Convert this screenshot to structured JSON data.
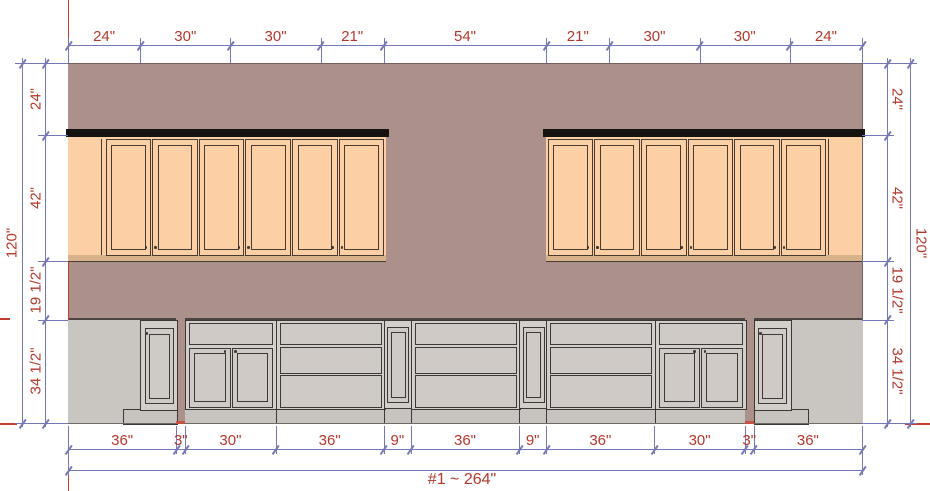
{
  "drawing": {
    "annotations": {
      "hood": "Hood",
      "spice_left": "Spice",
      "cooktop": "Cooktop",
      "spice_right": "Spice"
    },
    "overall_label": "#1 ~ 264\"",
    "dims": {
      "top": {
        "labels": [
          "24\"",
          "30\"",
          "30\"",
          "21\"",
          "54\"",
          "21\"",
          "30\"",
          "30\"",
          "24\""
        ],
        "inches": [
          24,
          30,
          30,
          21,
          54,
          21,
          30,
          30,
          24
        ]
      },
      "bottom": {
        "labels": [
          "36\"",
          "3\"",
          "30\"",
          "36\"",
          "9\"",
          "36\"",
          "9\"",
          "36\"",
          "30\"",
          "3\"",
          "36\""
        ],
        "inches": [
          36,
          3,
          30,
          36,
          9,
          36,
          9,
          36,
          30,
          3,
          36
        ]
      },
      "left": {
        "labels": [
          "24\"",
          "42\"",
          "19 1/2\"",
          "34 1/2\""
        ],
        "inches": [
          24,
          42,
          19.5,
          34.5
        ],
        "overall": "120\""
      },
      "right": {
        "labels": [
          "24\"",
          "42\"",
          "19 1/2\"",
          "34 1/2\""
        ],
        "inches": [
          24,
          42,
          19.5,
          34.5
        ],
        "overall": "120\""
      }
    },
    "colors": {
      "wall": "#ab908c",
      "wall_edge": "#74615e",
      "upper_cabinet": "#fcd0a4",
      "upper_stile": "#e3bd96",
      "upper_rail": "#d8b28a",
      "upper_line": "#463a31",
      "crown": "#15120f",
      "base_face": "#d2cec9",
      "base_front": "#cfcac6",
      "base_line": "#3c3836",
      "toe": "#c7c3bf",
      "gray_panel": "#c9c5c1",
      "counter_line": "#4a4542",
      "floor_line": "#6e6a67",
      "dim_blue": "#7478b7",
      "dim_red": "#b5372b",
      "guide_red": "#c23b2e",
      "label_gray": "#3a3231"
    }
  }
}
